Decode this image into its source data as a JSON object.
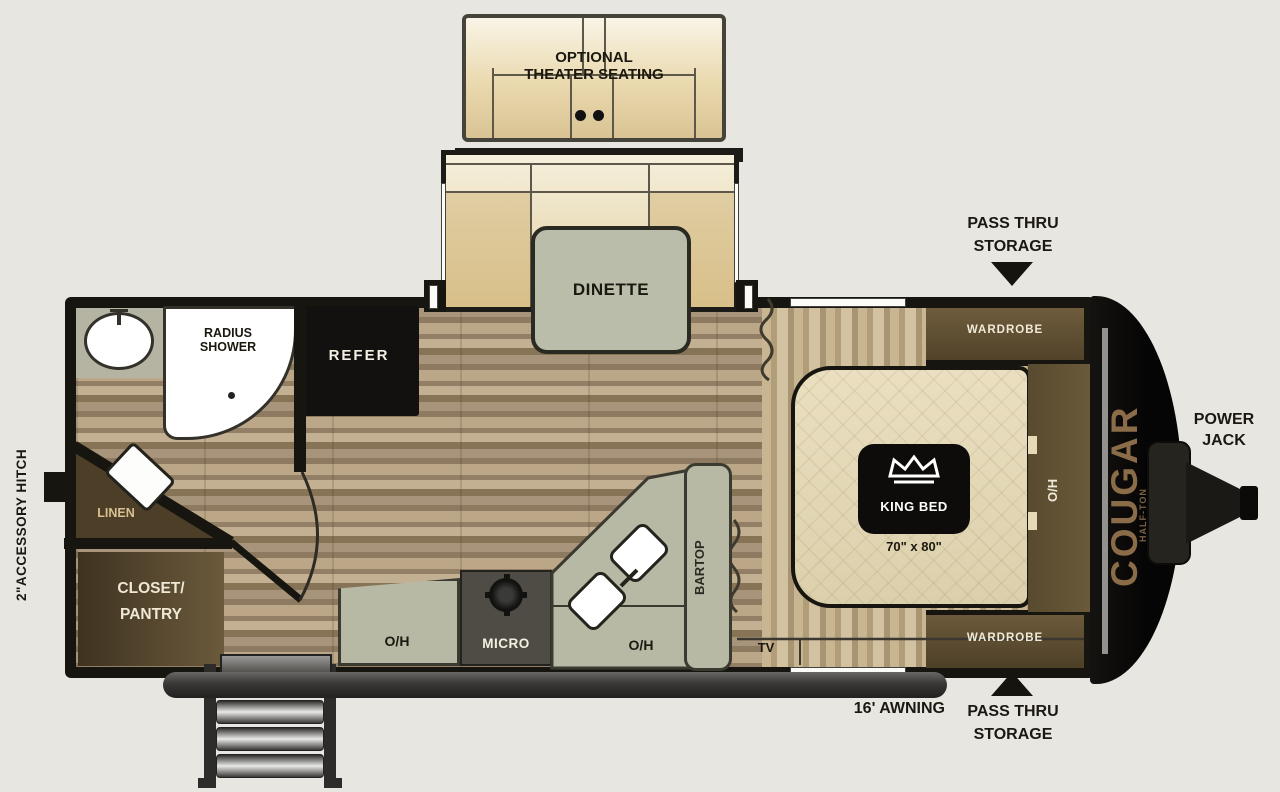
{
  "colors": {
    "background": "#e8e6e1",
    "wall": "#17150f",
    "floor_wood": "#9a8770",
    "carpet": "#c2ae8c",
    "cabinet_sage": "#b7b9a4",
    "dark_wood": "#5f5137",
    "bed_cream": "#e6dab6",
    "appliance_black": "#141210",
    "awning_gray": "#3a3836",
    "brand_text": "#8a6c48"
  },
  "icons": {
    "king_bed_badge": "crown-icon",
    "range_burner": "burner-icon",
    "pass_thru_top_arrow": "triangle-down",
    "pass_thru_bottom_arrow": "triangle-up"
  },
  "slideouts": {
    "theater": {
      "line1": "OPTIONAL",
      "line2": "THEATER SEATING"
    },
    "dinette": {
      "label": "DINETTE"
    }
  },
  "bathroom": {
    "shower_line1": "RADIUS",
    "shower_line2": "SHOWER",
    "linen": "LINEN"
  },
  "kitchen": {
    "refer": "REFER",
    "overhead_left": "O/H",
    "micro": "MICRO",
    "overhead_right": "O/H",
    "bartop": "BARTOP"
  },
  "storage": {
    "closet_line1": "CLOSET/",
    "closet_line2": "PANTRY",
    "wardrobe_top": "WARDROBE",
    "wardrobe_bottom": "WARDROBE",
    "pass_thru_top": {
      "line1": "PASS THRU",
      "line2": "STORAGE"
    },
    "pass_thru_bottom": {
      "line1": "PASS THRU",
      "line2": "STORAGE"
    }
  },
  "bedroom": {
    "bed_label": "KING BED",
    "bed_size": "70\" x 80\"",
    "overhead": "O/H",
    "tv": "TV"
  },
  "exterior": {
    "awning": "16' AWNING",
    "power_jack": {
      "line1": "POWER",
      "line2": "JACK"
    },
    "hitch": "2\"ACCESSORY HITCH",
    "brand": "COUGAR",
    "brand_sub": "HALF-TON"
  }
}
